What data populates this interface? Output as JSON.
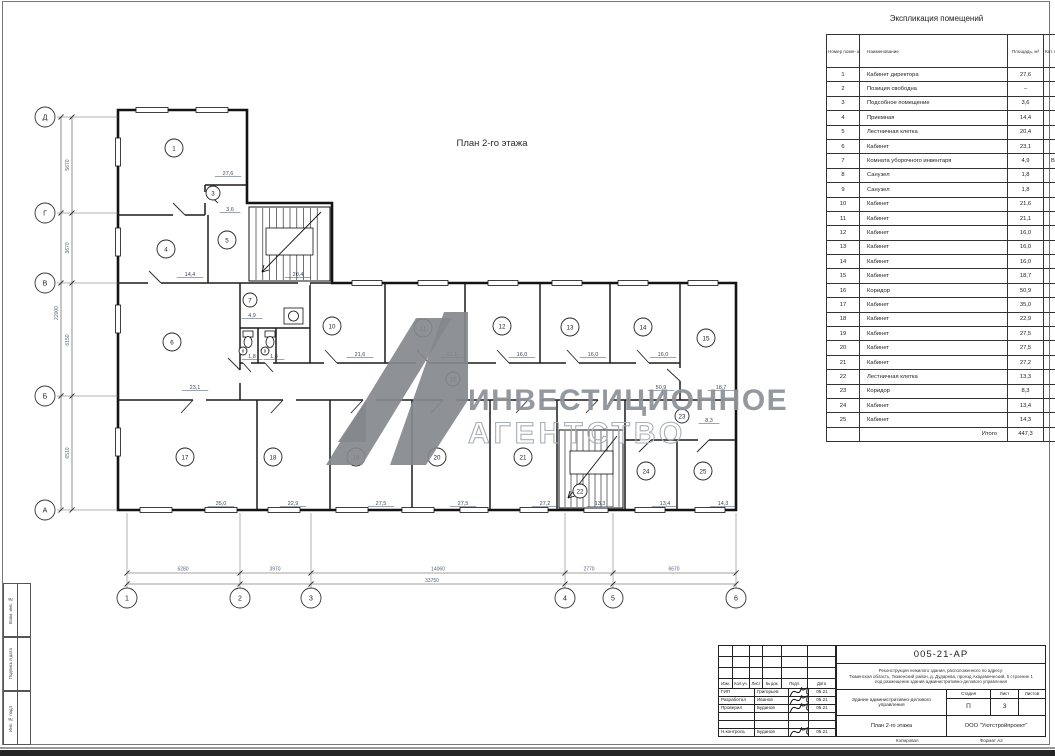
{
  "sheet": {
    "plan_title": "План 2-го этажа",
    "watermark": {
      "logo": "a1-invest-logo",
      "line1": "ИНВЕСТИЦИОННОЕ",
      "line2": "АГЕНТСТВО",
      "color": "#8e949a"
    },
    "frame_labels": [
      "Взам. инв. №",
      "Подпись и дата",
      "Инв. № подл."
    ]
  },
  "plan": {
    "rooms": [
      {
        "n": "1",
        "x": 174,
        "y": 148
      },
      {
        "n": "3",
        "x": 213,
        "y": 193,
        "r": 7
      },
      {
        "n": "4",
        "x": 166,
        "y": 249
      },
      {
        "n": "5",
        "x": 227,
        "y": 240
      },
      {
        "n": "6",
        "x": 172,
        "y": 342
      },
      {
        "n": "7",
        "x": 250,
        "y": 300,
        "r": 7
      },
      {
        "n": "8",
        "x": 243,
        "y": 351,
        "r": 4
      },
      {
        "n": "9",
        "x": 265,
        "y": 351,
        "r": 4
      },
      {
        "n": "10",
        "x": 332,
        "y": 326
      },
      {
        "n": "11",
        "x": 423,
        "y": 328
      },
      {
        "n": "12",
        "x": 502,
        "y": 326
      },
      {
        "n": "13",
        "x": 570,
        "y": 327
      },
      {
        "n": "14",
        "x": 643,
        "y": 327
      },
      {
        "n": "15",
        "x": 706,
        "y": 338
      },
      {
        "n": "16",
        "x": 453,
        "y": 379,
        "r": 7
      },
      {
        "n": "17",
        "x": 185,
        "y": 457
      },
      {
        "n": "18",
        "x": 273,
        "y": 457
      },
      {
        "n": "19",
        "x": 356,
        "y": 457
      },
      {
        "n": "20",
        "x": 437,
        "y": 457
      },
      {
        "n": "21",
        "x": 523,
        "y": 457
      },
      {
        "n": "22",
        "x": 580,
        "y": 491,
        "r": 7
      },
      {
        "n": "23",
        "x": 682,
        "y": 416,
        "r": 7
      },
      {
        "n": "24",
        "x": 646,
        "y": 471
      },
      {
        "n": "25",
        "x": 703,
        "y": 471
      }
    ],
    "areas": [
      {
        "t": "27,6",
        "x": 228,
        "y": 175
      },
      {
        "t": "3,6",
        "x": 230,
        "y": 211
      },
      {
        "t": "14,4",
        "x": 190,
        "y": 276
      },
      {
        "t": "20,4",
        "x": 298,
        "y": 276
      },
      {
        "t": "23,1",
        "x": 195,
        "y": 389
      },
      {
        "t": "4,9",
        "x": 252,
        "y": 317
      },
      {
        "t": "1,8",
        "x": 252,
        "y": 358
      },
      {
        "t": "1,8",
        "x": 274,
        "y": 358
      },
      {
        "t": "21,6",
        "x": 360,
        "y": 356
      },
      {
        "t": "21,1",
        "x": 452,
        "y": 356
      },
      {
        "t": "16,0",
        "x": 522,
        "y": 356
      },
      {
        "t": "16,0",
        "x": 593,
        "y": 356
      },
      {
        "t": "16,0",
        "x": 663,
        "y": 356
      },
      {
        "t": "50,9",
        "x": 661,
        "y": 389
      },
      {
        "t": "18,7",
        "x": 721,
        "y": 389
      },
      {
        "t": "35,0",
        "x": 221,
        "y": 505
      },
      {
        "t": "22,9",
        "x": 293,
        "y": 505
      },
      {
        "t": "27,5",
        "x": 381,
        "y": 505
      },
      {
        "t": "27,5",
        "x": 463,
        "y": 505
      },
      {
        "t": "27,2",
        "x": 545,
        "y": 505
      },
      {
        "t": "13,3",
        "x": 600,
        "y": 505
      },
      {
        "t": "13,4",
        "x": 665,
        "y": 505
      },
      {
        "t": "14,3",
        "x": 723,
        "y": 505
      },
      {
        "t": "8,3",
        "x": 709,
        "y": 422
      }
    ],
    "axes_bottom": [
      {
        "t": "1",
        "x": 127
      },
      {
        "t": "2",
        "x": 240
      },
      {
        "t": "3",
        "x": 311
      },
      {
        "t": "4",
        "x": 565
      },
      {
        "t": "5",
        "x": 613
      },
      {
        "t": "6",
        "x": 736
      }
    ],
    "axes_left": [
      {
        "t": "Д",
        "y": 117
      },
      {
        "t": "Г",
        "y": 213
      },
      {
        "t": "В",
        "y": 283
      },
      {
        "t": "Б",
        "y": 396
      },
      {
        "t": "А",
        "y": 510
      }
    ],
    "dims_bottom": [
      {
        "t": "6280",
        "x": 183
      },
      {
        "t": "3970",
        "x": 275
      },
      {
        "t": "14060",
        "x": 438
      },
      {
        "t": "2770",
        "x": 589
      },
      {
        "t": "6670",
        "x": 674
      }
    ],
    "dims_bottom_total": "33750",
    "dims_left": [
      {
        "t": "5670",
        "y": 165
      },
      {
        "t": "3670",
        "y": 248
      },
      {
        "t": "6150",
        "y": 340
      },
      {
        "t": "6510",
        "y": 453
      }
    ],
    "dims_left_total": "22000"
  },
  "explication": {
    "title": "Экспликация помещений",
    "headers": [
      "Номер поме- щения",
      "Наименование",
      "Площадь, м²",
      "Кат. поме- щения"
    ],
    "rows": [
      [
        "1",
        "Кабинет директора",
        "27,6",
        ""
      ],
      [
        "2",
        "Позиция свободна",
        "–",
        ""
      ],
      [
        "3",
        "Подсобное помещение",
        "3,6",
        ""
      ],
      [
        "4",
        "Приемная",
        "14,4",
        ""
      ],
      [
        "5",
        "Лестничная клетка",
        "20,4",
        ""
      ],
      [
        "6",
        "Кабинет",
        "23,1",
        ""
      ],
      [
        "7",
        "Комната уборочного инвентаря",
        "4,9",
        "В4"
      ],
      [
        "8",
        "Санузел",
        "1,8",
        ""
      ],
      [
        "9",
        "Санузел",
        "1,8",
        ""
      ],
      [
        "10",
        "Кабинет",
        "21,6",
        ""
      ],
      [
        "11",
        "Кабинет",
        "21,1",
        ""
      ],
      [
        "12",
        "Кабинет",
        "16,0",
        ""
      ],
      [
        "13",
        "Кабинет",
        "16,0",
        ""
      ],
      [
        "14",
        "Кабинет",
        "16,0",
        ""
      ],
      [
        "15",
        "Кабинет",
        "18,7",
        ""
      ],
      [
        "16",
        "Коридор",
        "50,9",
        ""
      ],
      [
        "17",
        "Кабинет",
        "35,0",
        ""
      ],
      [
        "18",
        "Кабинет",
        "22,9",
        ""
      ],
      [
        "19",
        "Кабинет",
        "27,5",
        ""
      ],
      [
        "20",
        "Кабинет",
        "27,5",
        ""
      ],
      [
        "21",
        "Кабинет",
        "27,2",
        ""
      ],
      [
        "22",
        "Лестничная клетка",
        "13,3",
        ""
      ],
      [
        "23",
        "Коридор",
        "8,3",
        ""
      ],
      [
        "24",
        "Кабинет",
        "13,4",
        ""
      ],
      [
        "25",
        "Кабинет",
        "14,3",
        ""
      ]
    ],
    "total_label": "Итого",
    "total": "447,3"
  },
  "titleblock": {
    "doc_number": "005-21-АР",
    "description_lines": [
      "Реконструкция нежилого здания, расположенного по адресу:",
      "Тюменская область, Тюменский район, д. Дударева, проезд Академический, 5 строение 1",
      "под размещение здания административно-делового управления"
    ],
    "object_name": "Здание административно-делового управления",
    "drawing_name": "План 2-го этажа",
    "company": "ООО \"Уютстройпроект\"",
    "header_cols": [
      "Изм.",
      "Кол.уч.",
      "Лист",
      "№ док.",
      "Подп.",
      "Дата"
    ],
    "rows": [
      {
        "role": "ГИП",
        "name": "Григорьев",
        "date": "05.21",
        "sig": true
      },
      {
        "role": "Разработал",
        "name": "Иванов",
        "date": "05.21",
        "sig": true
      },
      {
        "role": "Проверил",
        "name": "Буданов",
        "date": "05.21",
        "sig": true
      },
      {
        "role": "",
        "name": "",
        "date": "",
        "sig": false
      },
      {
        "role": "",
        "name": "",
        "date": "",
        "sig": false
      },
      {
        "role": "Н.контроль",
        "name": "Буданов",
        "date": "05.21",
        "sig": true
      }
    ],
    "stage_label": "Стадия",
    "stage": "П",
    "sheet_label": "Лист",
    "sheet": "3",
    "sheets_label": "Листов",
    "sheets": "",
    "copied_label": "Копировал",
    "format_label": "Формат А2"
  }
}
